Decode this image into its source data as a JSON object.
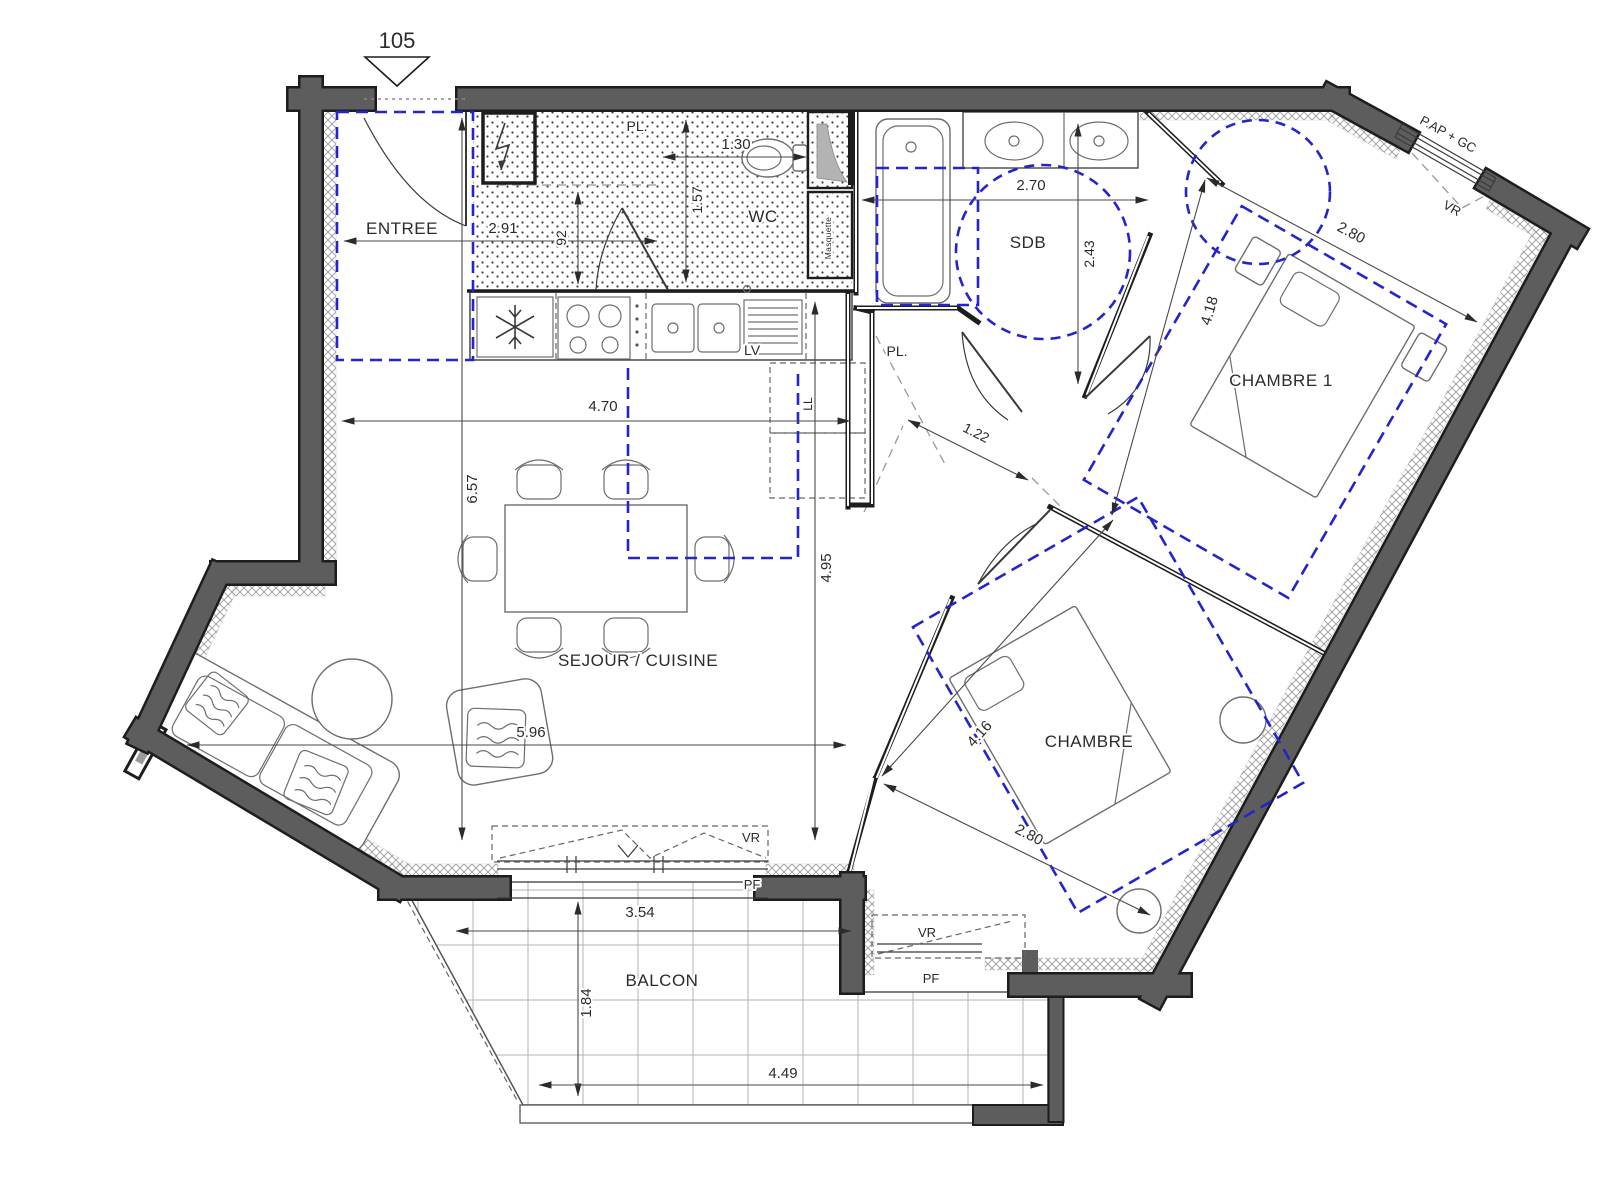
{
  "meta": {
    "unit_number": "105",
    "drawing_type": "apartment floor plan"
  },
  "rooms": {
    "entree": "ENTREE",
    "wc": "WC",
    "sdb": "SDB",
    "pl": "PL.",
    "chambre1": "CHAMBRE 1",
    "chambre": "CHAMBRE",
    "sejour": "SEJOUR / CUISINE",
    "balcon": "BALCON"
  },
  "appliances": {
    "dishwasher": "LV",
    "washer": "LL"
  },
  "openings": {
    "roller_shutter": "VR",
    "french_window": "PF",
    "bay": "P.AP + GC",
    "duct": "Masquette"
  },
  "dimensions": {
    "entree_w": "2.91",
    "entree_d": "92",
    "wc_w": "1.30",
    "wc_d": "1.57",
    "sdb_w": "2.70",
    "sdb_d": "2.43",
    "ch1_w": "2.80",
    "ch1_l": "4.18",
    "sejour_w": "4.70",
    "sejour_h": "6.57",
    "sejour_d": "4.95",
    "sejour_l": "5.96",
    "hall_w": "1.22",
    "ch_l": "4.16",
    "ch_w": "2.80",
    "balcon_w": "3.54",
    "balcon_d": "1.84",
    "balcon_l": "4.49"
  },
  "colors": {
    "wall": "#5d5d5d",
    "accent_blue": "#2424cc",
    "line": "#3a3a3a",
    "hatch": "#9a9a9a"
  }
}
